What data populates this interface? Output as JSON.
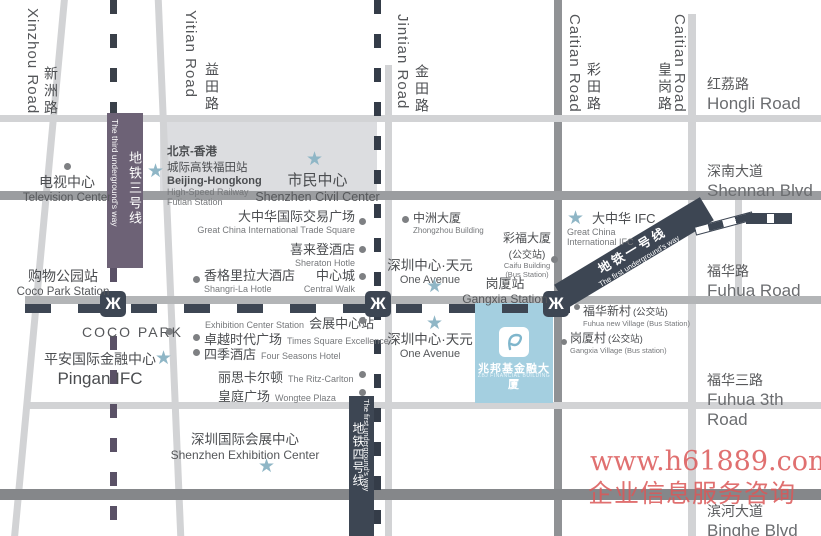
{
  "roads": {
    "xinzhou": {
      "cn": "新洲路",
      "en": "Xinzhou Road"
    },
    "yitian": {
      "cn": "益田路",
      "en": "Yitian Road"
    },
    "jintian": {
      "cn": "金田路",
      "en": "Jintian Road"
    },
    "caitian": {
      "cn": "彩田路",
      "en": "Caitian Road"
    },
    "huanggang": {
      "cn": "皇岗路",
      "en": "Caitian Road"
    },
    "hongli": {
      "cn": "红荔路",
      "en": "Hongli Road"
    },
    "shennan": {
      "cn": "深南大道",
      "en": "Shennan  Blvd"
    },
    "fuhua": {
      "cn": "福华路",
      "en": "Fuhua Road"
    },
    "fuhua3": {
      "cn": "福华三路",
      "en": "Fuhua 3th Road"
    },
    "binghe": {
      "cn": "滨河大道",
      "en": "Binghe  Blvd"
    }
  },
  "metro": {
    "line3": {
      "cn": "地铁三号线",
      "en": "The third underground's way"
    },
    "line1": {
      "cn": "地铁一号线",
      "en": "The first underground's way"
    },
    "line4": {
      "cn": "地铁四号线",
      "en": "The first underground's way"
    }
  },
  "icons": {
    "metro_logo_glyph": "Ж"
  },
  "landmarks": {
    "tv_center": {
      "cn": "电视中心",
      "en": "Television Center"
    },
    "beijing_hk": {
      "cn1": "北京-香港",
      "cn2": "城际高铁福田站",
      "en1": "Beijing-Hongkong",
      "en2": "High-Speed Railway",
      "en3": "Futian Station"
    },
    "civil_center": {
      "cn": "市民中心",
      "en": "Shenzhen Civil Center"
    },
    "gc_trade": {
      "cn": "大中华国际交易广场",
      "en": "Great China International Trade Square"
    },
    "sheraton": {
      "cn": "喜来登酒店",
      "en": "Sheraton Hotle"
    },
    "shangrila": {
      "cn": "香格里拉大酒店",
      "en": "Shangri-La Hotle"
    },
    "central_walk": {
      "cn": "中心城",
      "en": "Central Walk"
    },
    "exh_station": {
      "en": "Exhibition Center Station",
      "cn": "会展中心站"
    },
    "times_square": {
      "cn": "卓越时代广场",
      "en": "Times Square Excellence"
    },
    "four_seasons": {
      "cn": "四季酒店",
      "en": "Four Seasons Hotel"
    },
    "ritz": {
      "cn": "丽思卡尔顿",
      "en": "The Ritz-Carlton"
    },
    "wongtee": {
      "cn": "皇庭广场",
      "en": "Wongtee  Plaza"
    },
    "coco_station": {
      "cn": "购物公园站",
      "en": "Coco Park Station"
    },
    "coco_park": {
      "en": "COCO PARK"
    },
    "pingan": {
      "cn": "平安国际金融中心",
      "en": "Pingan  IFC"
    },
    "sz_exhibition": {
      "cn": "深圳国际会展中心",
      "en": "Shenzhen Exhibition Center"
    },
    "zhongzhou": {
      "cn": "中洲大厦",
      "en": "Zhongzhou Building"
    },
    "one_avenue_u": {
      "cn": "深圳中心·天元",
      "en": "One Avenue"
    },
    "one_avenue_l": {
      "cn": "深圳中心·天元",
      "en": "One Avenue"
    },
    "caifu": {
      "cn1": "彩福大厦",
      "cn2": "(公交站)",
      "en1": "Caifu Building",
      "en2": "(Bus Station)"
    },
    "gangxia_st": {
      "cn": "岗厦站",
      "en": "Gangxia Station"
    },
    "gc_ifc": {
      "cn": "大中华 IFC",
      "en1": "Great China",
      "en2": "International IFC"
    },
    "fuhua_village": {
      "cn": "福华新村",
      "cn2": "(公交站)",
      "en": "Fuhua new  Village (Bus Station)"
    },
    "gangxia_village": {
      "cn": "岗厦村",
      "cn2": "(公交站)",
      "en": "Gangxia Village (Bus station)"
    }
  },
  "building": {
    "cn": "兆邦基金融大厦",
    "en": "ZBJ FINANCIAL BUILDING"
  },
  "watermark": {
    "line1": "www.h61889.com",
    "line2": "企业信息服务咨询"
  }
}
